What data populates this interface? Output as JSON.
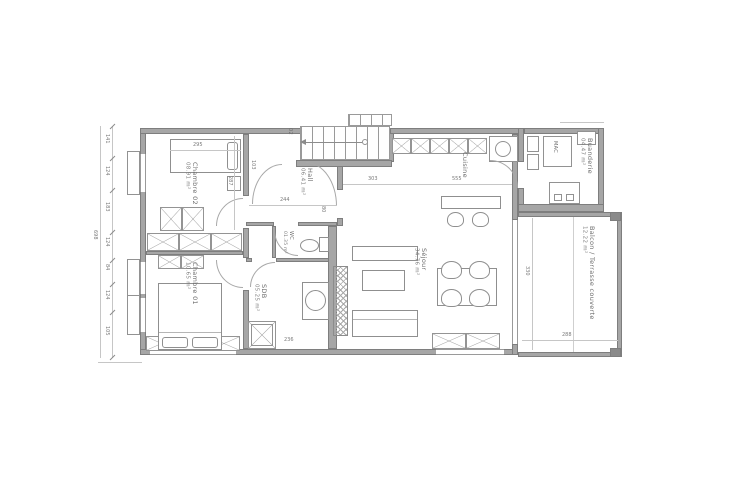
{
  "rooms": [
    {
      "name": "Chambre 02",
      "area": "08.91 m²"
    },
    {
      "name": "Chambre 01",
      "area": "10.65 m²"
    },
    {
      "name": "Hall",
      "area": "06.41 m²"
    },
    {
      "name": "WC",
      "area": "01.35 m²"
    },
    {
      "name": "SDB",
      "area": "05.25 m²"
    },
    {
      "name": "Séjour",
      "area": "34.76 m²"
    },
    {
      "name": "Cuisine",
      "area": ""
    },
    {
      "name": "Buanderie",
      "area": "04.47 m²"
    },
    {
      "name": "Balcon / Terrasse couverte",
      "area": "12.22 m²"
    }
  ],
  "stairs": {
    "label": "02"
  },
  "appliances": {
    "washing_machine": "MAC"
  },
  "dims": {
    "bed_ch02": "295",
    "ch02_height": "287",
    "stair_offset": "103",
    "hall_width": "244",
    "door_width": "80",
    "sejour_a": "303",
    "sejour_b": "555",
    "sdb_width": "236",
    "balcony_height": "330",
    "balcony_width": "288",
    "left_total": "698",
    "left_chain": [
      "141",
      "124",
      "183",
      "124",
      "84",
      "124",
      "105"
    ]
  },
  "colors": {
    "wall": "#a6a6a6",
    "line": "#8f8f8f",
    "text": "#6d6d6d",
    "background": "#ffffff"
  }
}
